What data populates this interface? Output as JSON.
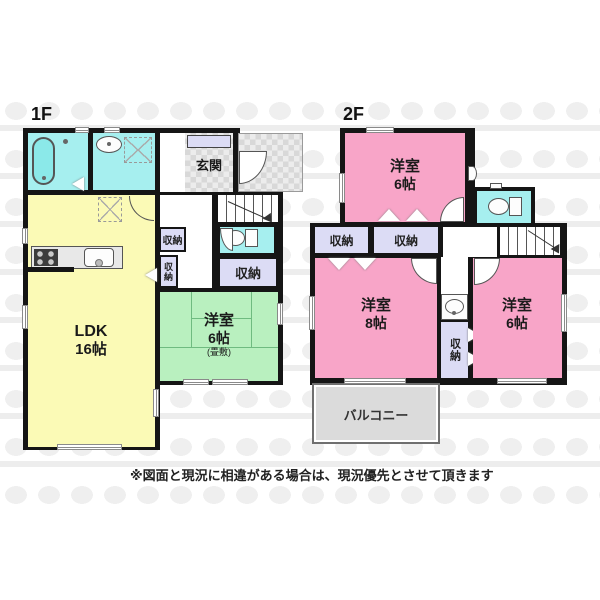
{
  "floor1": {
    "label": "1F",
    "ldk_name": "LDK",
    "ldk_size": "16帖",
    "tatami_name": "洋室",
    "tatami_size": "6帖",
    "tatami_note": "(畳敷)",
    "entrance": "玄関",
    "closet_hall": "収納",
    "closet_hall_small": "収納",
    "closet_big": "収納"
  },
  "floor2": {
    "label": "2F",
    "room_top_name": "洋室",
    "room_top_size": "6帖",
    "room_left_name": "洋室",
    "room_left_size": "8帖",
    "room_right_name": "洋室",
    "room_right_size": "6帖",
    "closet_left": "収納",
    "closet_mid": "収納",
    "closet_tall": "収納",
    "balcony": "バルコニー"
  },
  "disclaimer": "※図面と現況に相違がある場合は、現況優先とさせて頂きます",
  "colors": {
    "wall": "#151515",
    "room_pink": "#F8A5C8",
    "room_green": "#B9F0BF",
    "room_yellow": "#FBFAB6",
    "wet_cyan": "#A6EFEF",
    "closet_lavender": "#DCDCF5",
    "balcony_gray": "#DBDBDB"
  },
  "icons": [
    "bathtub-icon",
    "shower-icon",
    "washbasin-icon",
    "laundry-space-icon",
    "toilet-icon",
    "refrigerator-space-icon",
    "kitchen-stove-icon",
    "kitchen-sink-icon",
    "stairs-up-arrow-icon",
    "stairs-down-arrow-icon"
  ]
}
